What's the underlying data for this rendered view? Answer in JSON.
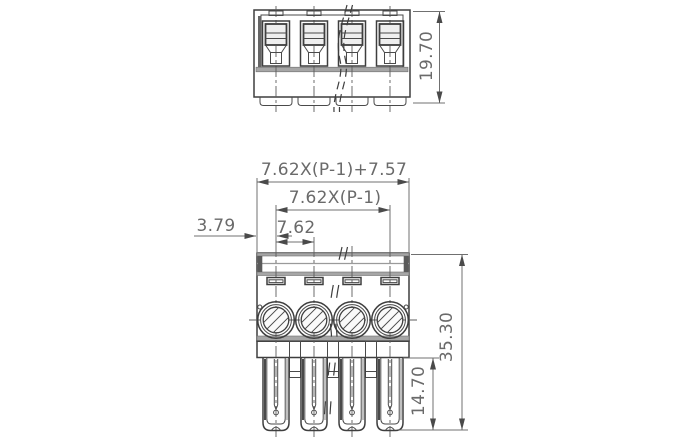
{
  "drawing": {
    "colors": {
      "line": "#3e3e3e",
      "band_gray": "#a6a6a6",
      "dimension_gray": "#6a6a6a",
      "background": "#ffffff"
    },
    "views": {
      "top_view": {
        "positions_shown": 4
      },
      "front_view": {
        "positions_shown": 4
      }
    },
    "dimensions": {
      "overall_width": "7.62X(P-1)+7.57",
      "pitch_span": "7.62X(P-1)",
      "pitch": "7.62",
      "edge_to_first_pole": "3.79",
      "top_view_height": "19.70",
      "overall_height": "35.30",
      "pin_length": "14.70"
    }
  }
}
